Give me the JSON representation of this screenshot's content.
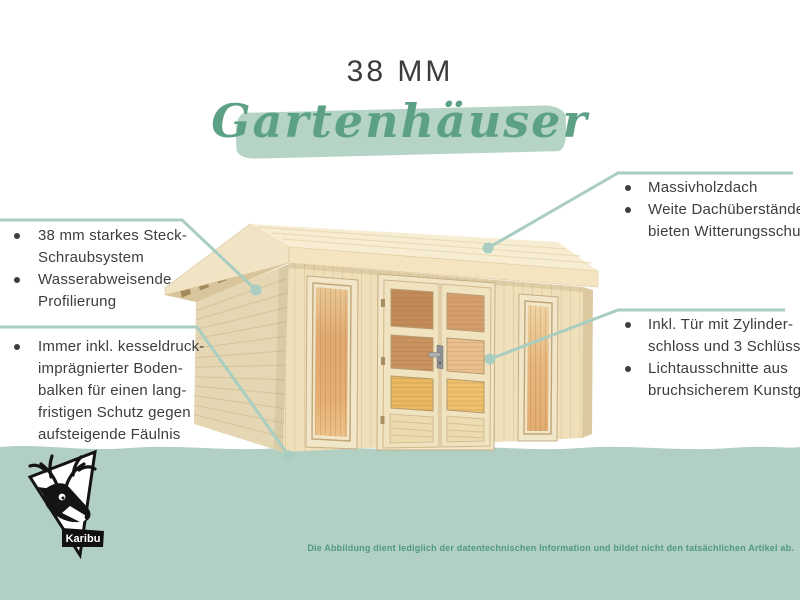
{
  "title": "38 MM",
  "subtitle": "Gartenhäuser",
  "features": {
    "left_top": {
      "bullets": [
        {
          "lines": [
            "38 mm starkes Steck-",
            "Schraubsystem"
          ]
        },
        {
          "lines": [
            "Wasserabweisende",
            "Profilierung"
          ]
        }
      ]
    },
    "left_bottom": {
      "bullets": [
        {
          "lines": [
            "Immer inkl. kesseldruck-",
            "imprägnierter Boden-",
            "balken für einen lang-",
            "fristigen Schutz gegen",
            "aufsteigende Fäulnis"
          ]
        }
      ]
    },
    "right_top": {
      "bullets": [
        {
          "lines": [
            "Massivholzdach"
          ]
        },
        {
          "lines": [
            "Weite Dachüberstände",
            "bieten Witterungsschutz"
          ]
        }
      ]
    },
    "right_bottom": {
      "bullets": [
        {
          "lines": [
            "Inkl. Tür mit Zylinder-",
            "schloss und 3 Schlüsseln"
          ]
        },
        {
          "lines": [
            "Lichtausschnitte aus",
            "bruchsicherem Kunstglas"
          ]
        }
      ]
    }
  },
  "footer": {
    "disclaimer": "Die Abbildung dient lediglich der datentechnischen Information und bildet nicht den tatsächlichen Artikel ab."
  },
  "logo": {
    "brand": "Karibu"
  },
  "colors": {
    "background": "#ffffff",
    "ground_band": "#b2cfc3",
    "brush_stroke": "#b5d4c6",
    "script_green": "#5ca186",
    "disclaimer_green": "#4f9a82",
    "callout_teal": "#a9cec1",
    "text_dark": "#3d3d3f"
  }
}
